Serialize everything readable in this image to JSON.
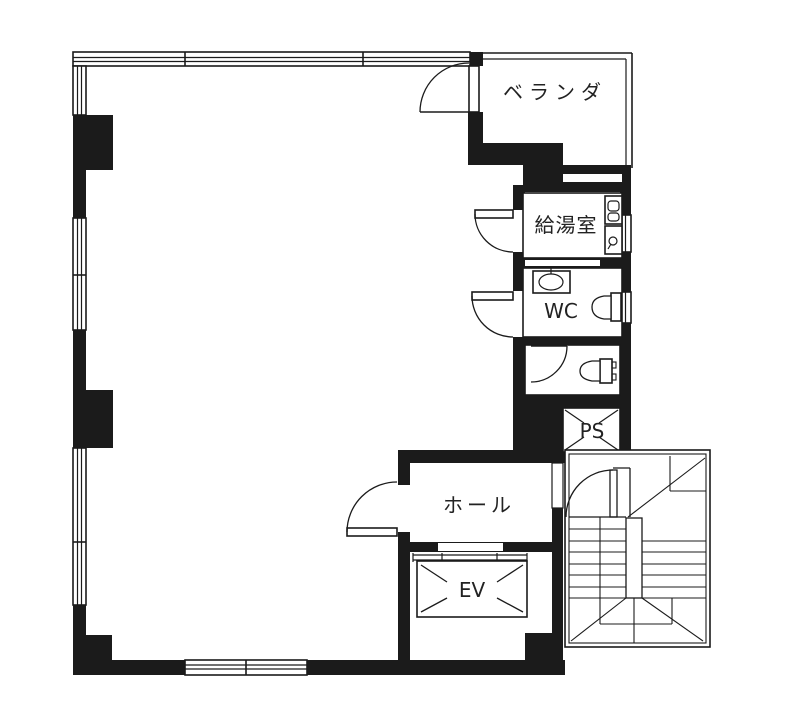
{
  "plan": {
    "type": "architectural-floor-plan",
    "colors": {
      "background": "#ffffff",
      "ink": "#1b1b1b",
      "label_ink": "#222222"
    },
    "rooms": {
      "veranda": {
        "label": "ベランダ"
      },
      "kitchenette": {
        "label": "給湯室"
      },
      "toilet": {
        "label": "WC"
      },
      "pipe_shaft": {
        "label": "PS"
      },
      "hall": {
        "label": "ホール"
      },
      "elevator": {
        "label": "EV"
      }
    }
  }
}
